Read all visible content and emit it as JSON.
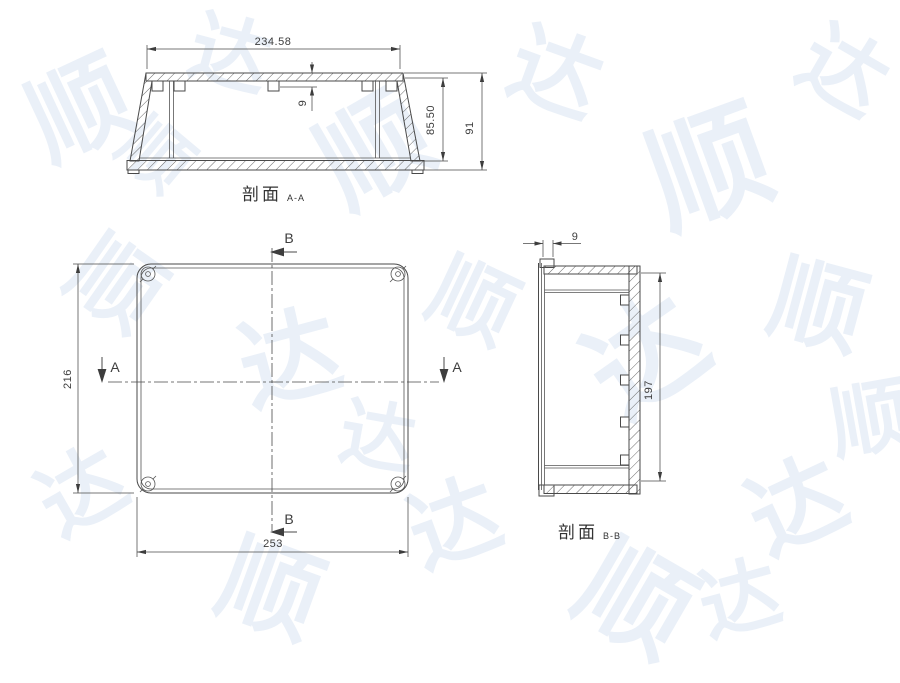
{
  "page": {
    "background_color": "#ffffff",
    "line_color": "#4a4a4a",
    "text_color": "#3d3d3d"
  },
  "watermark": {
    "text": "顺达",
    "color": "rgba(168,194,224,0.24)"
  },
  "views": {
    "section_aa": {
      "title": "剖面",
      "title_suffix": "A-A",
      "dim_width": "234.58",
      "dim_boss_depth": "9",
      "dim_inner_height": "85.50",
      "dim_outer_height": "91"
    },
    "plan": {
      "dim_height": "216",
      "dim_width": "253",
      "marker_a": "A",
      "marker_b": "B"
    },
    "section_bb": {
      "title": "剖面",
      "title_suffix": "B-B",
      "dim_lip": "9",
      "dim_height": "197"
    }
  }
}
